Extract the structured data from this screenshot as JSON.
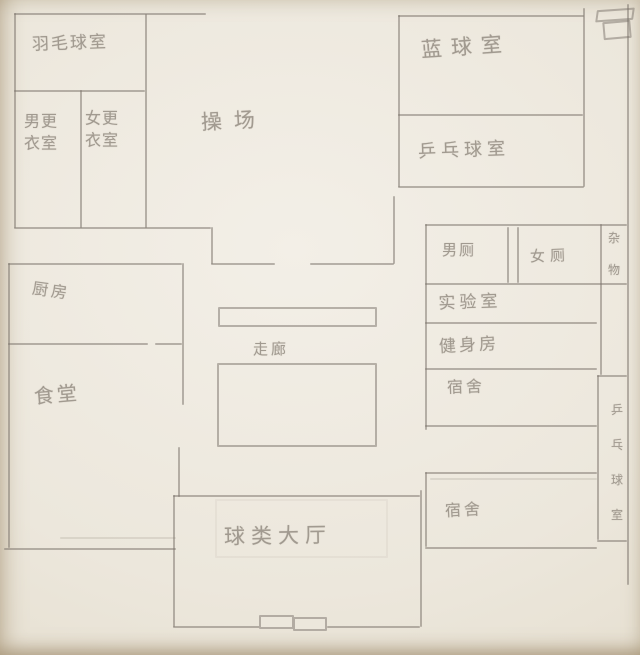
{
  "palette": {
    "paper": "#ece7dc",
    "pencil_line": "#7a7269",
    "pencil_text": "#a19a90"
  },
  "rooms": {
    "badminton": {
      "label": "羽毛球室"
    },
    "mens_changing": {
      "label": "男更\n衣室"
    },
    "womens_changing": {
      "label": "女更\n衣室"
    },
    "playground": {
      "label": "操场"
    },
    "basketball": {
      "label": "蓝球室"
    },
    "table_tennis": {
      "label": "乒乓球室"
    },
    "mens_toilet": {
      "label": "男厕"
    },
    "womens_toilet": {
      "label": "女厕"
    },
    "storage": {
      "label": "杂\n物"
    },
    "lab": {
      "label": "实验室"
    },
    "gym": {
      "label": "健身房"
    },
    "dorm_upper": {
      "label": "宿舍"
    },
    "dorm_lower": {
      "label": "宿舍"
    },
    "kitchen": {
      "label": "厨房"
    },
    "canteen": {
      "label": "食堂"
    },
    "corridor": {
      "label": "走廊"
    },
    "table_tennis_side": {
      "label": "乒\n乓\n球\n室"
    },
    "hall": {
      "label": "球类大厅"
    }
  },
  "icons": {
    "corner_cabinet": "cabinet-icon",
    "hall_entrance": "double-door-icon"
  }
}
